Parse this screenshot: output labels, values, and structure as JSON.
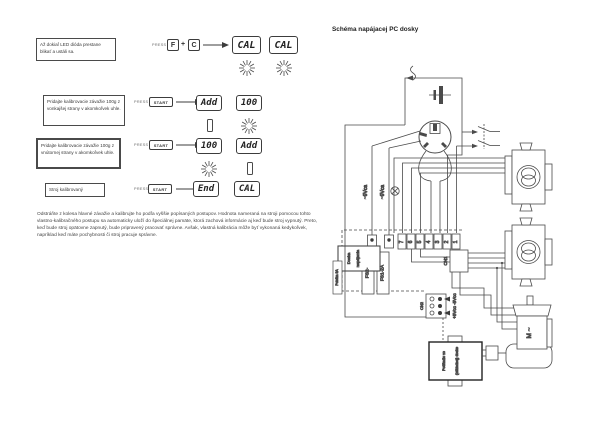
{
  "doc": {
    "steps": [
      {
        "note": "Až dokiaľ LED dióda prestane blikať a ustáli sa.",
        "press": "PRESS",
        "key1": "F",
        "plus": "+",
        "key2": "C",
        "disp1": "CAL",
        "disp2": "CAL"
      },
      {
        "note": "Pridajte kalibrovacie závažie 100g z vonkajšej strany v akomkoľvek uhle.",
        "press": "PRESS",
        "key1": "START",
        "disp1": "Add",
        "disp2": "100"
      },
      {
        "note": "Pridajte kalibrovacie závažie 100g z vnútornej strany v akomkoľvek uhle.",
        "press": "PRESS",
        "key1": "START",
        "disp1": "100",
        "disp2": "Add"
      },
      {
        "note": "Stroj kalibrovaný",
        "press": "PRESS",
        "key1": "START",
        "disp1": "End",
        "disp2": "CAL"
      }
    ],
    "paragraph": "Odstráňte z kolesa hlavné závažie a kalibrujte ho podľa vyššie popísaných postupov. Hodnota nameraná na stroji pomocou tohto vlastno-kalibračného postupu sa automaticky uloží do špeciálnej pamäte, ktorá zachová informácie aj keď bude stroj vypnutý. Preto, keď bude stroj opätovne zapnutý, bude pripravený pracovať správne. Avšak, vlastná kalibrácia môže byť vykonaná kedykoľvek, napríklad keď máte pochybnosti či stroj pracuje správne."
  },
  "schematic": {
    "title": "Schéma napájacej PC dosky",
    "labels": {
      "ac_left": "~9Vca",
      "ac_right": "~9Vca",
      "board_box_1": "Doska",
      "board_box_2": "napájania",
      "fuse_note": "Poistka 8A",
      "fuse2": "FS2-",
      "fuse1": "FS1-2A",
      "terminals": [
        "7",
        "6",
        "5",
        "4",
        "3",
        "2",
        "1"
      ],
      "cn1": "CN1",
      "cn2": "CN2",
      "vcc": "+5Vcc  -5Vcc",
      "counter1": "Počítadlo vo",
      "counter2": "(základnej) doske",
      "motor": "M ~"
    }
  },
  "colors": {
    "ink": "#3a3a3a",
    "line": "#4a4a4a",
    "bg": "#ffffff"
  }
}
